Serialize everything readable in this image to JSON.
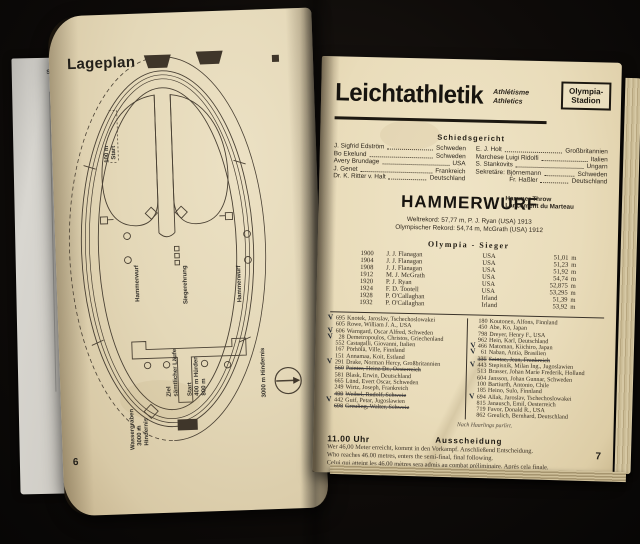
{
  "book": {
    "left_page_number": "6",
    "right_page_number": "7",
    "inserted_sheet_text": "Sc"
  },
  "lageplan": {
    "title": "Lageplan",
    "labels": {
      "start100_l1": "100 m",
      "start100_l2": "Start",
      "hammerwurf_left": "Hammerwurf",
      "hammerwurf_right": "Hammerwurf",
      "siegerehrung": "Siegerehrung",
      "ziel_l1": "Ziel",
      "ziel_l2": "sämtlicher Läufe",
      "start400_l1": "Start",
      "start400_l2": "400 m Hürden",
      "start400_l3": "800 m",
      "wassergraben_l1": "Wassergraben",
      "wassergraben_l2": "3000 m",
      "wassergraben_l3": "Hindernis",
      "hindernis_right": "3000 m Hindernis"
    }
  },
  "header": {
    "title": "Leichtathletik",
    "subtitle_fr": "Athlétisme",
    "subtitle_en": "Athletics",
    "venue_line1": "Olympia-",
    "venue_line2": "Stadion"
  },
  "schiedsgericht": {
    "heading": "Schiedsgericht",
    "left": [
      {
        "name": "J. Sigfrid Edström",
        "country": "Schweden"
      },
      {
        "name": "Bo Ekelund",
        "country": "Schweden"
      },
      {
        "name": "Avery Brundage",
        "country": "USA"
      },
      {
        "name": "J. Genet",
        "country": "Frankreich"
      },
      {
        "name": "Dr. K. Ritter v. Halt",
        "country": "Deutschland"
      }
    ],
    "right": [
      {
        "name": "E. J. Holt",
        "country": "Großbritannien",
        "indent": false
      },
      {
        "name": "Marchese Luigi Ridolfi",
        "country": "Italien",
        "indent": false
      },
      {
        "name": "S. Stankovits",
        "country": "Ungarn",
        "indent": false
      },
      {
        "name": "Sekretäre: Björnemann",
        "country": "Schweden",
        "indent": false
      },
      {
        "name": "Fr. Haßler",
        "country": "Deutschland",
        "indent": true
      }
    ]
  },
  "hammerwurf": {
    "title": "HAMMERWURF",
    "subtitle_en": "Hammer Throw",
    "subtitle_fr": "Lancement du Marteau",
    "weltrekord": "Weltrekord: 57,77 m, P. J. Ryan (USA) 1913",
    "olympischer_rekord": "Olympischer Rekord: 54,74 m, McGrath (USA) 1912",
    "sieger_heading": "Olympia - Sieger",
    "winners": [
      {
        "year": "1900",
        "name": "J. J. Flanagan",
        "country": "USA",
        "distance": "51,01"
      },
      {
        "year": "1904",
        "name": "J. J. Flanagan",
        "country": "USA",
        "distance": "51,23"
      },
      {
        "year": "1908",
        "name": "J. J. Flanagan",
        "country": "USA",
        "distance": "51,92"
      },
      {
        "year": "1912",
        "name": "M. J. McGrath",
        "country": "USA",
        "distance": "54,74"
      },
      {
        "year": "1920",
        "name": "P. J. Ryan",
        "country": "USA",
        "distance": "52,875"
      },
      {
        "year": "1924",
        "name": "F. D. Tootell",
        "country": "USA",
        "distance": "53,295"
      },
      {
        "year": "1928",
        "name": "P. O'Callaghan",
        "country": "Irland",
        "distance": "51,39"
      },
      {
        "year": "1932",
        "name": "P. O'Callaghan",
        "country": "Irland",
        "distance": "53,92"
      }
    ],
    "meter_unit": "m",
    "competitors_left": [
      {
        "num": "695",
        "name": "Knotek, Jaroslav, Tschechoslowakei",
        "checked": true,
        "struck": false
      },
      {
        "num": "605",
        "name": "Rowe, William J. A., USA",
        "checked": false,
        "struck": false
      },
      {
        "num": "606",
        "name": "Warngard, Oscar Alfred, Schweden",
        "checked": true,
        "struck": false
      },
      {
        "num": "28",
        "name": "Demetropoulos, Christos, Griechenland",
        "checked": true,
        "struck": false
      },
      {
        "num": "552",
        "name": "Castagalli, Giovanni, Italien",
        "checked": false,
        "struck": false
      },
      {
        "num": "167",
        "name": "Pörhölä, Ville, Finnland",
        "checked": false,
        "struck": false
      },
      {
        "num": "151",
        "name": "Annamaa, Koit, Estland",
        "checked": false,
        "struck": false
      },
      {
        "num": "291",
        "name": "Drake, Norman Hercy, Großbritannien",
        "checked": true,
        "struck": false
      },
      {
        "num": "560",
        "name": "Painter, Heinz Dr., Oesterreich",
        "checked": false,
        "struck": true
      },
      {
        "num": "581",
        "name": "Blask, Erwin, Deutschland",
        "checked": false,
        "struck": false
      },
      {
        "num": "665",
        "name": "Lünd, Evert Oscar, Schweden",
        "checked": false,
        "struck": false
      },
      {
        "num": "249",
        "name": "Wirtz, Joseph, Frankreich",
        "checked": false,
        "struck": false
      },
      {
        "num": "499",
        "name": "Weibel, Rudolf, Schweiz",
        "checked": false,
        "struck": true
      },
      {
        "num": "442",
        "name": "Guif, Petar, Jugoslawien",
        "checked": true,
        "struck": false
      },
      {
        "num": "698",
        "name": "Greuling, Walter, Schweiz",
        "checked": false,
        "struck": true
      }
    ],
    "competitors_right": [
      {
        "num": "180",
        "name": "Koutonen, Alfons, Finnland",
        "checked": false,
        "struck": false
      },
      {
        "num": "450",
        "name": "Abe, Ko, Japan",
        "checked": false,
        "struck": false
      },
      {
        "num": "798",
        "name": "Dreyer, Henry F., USA",
        "checked": false,
        "struck": false
      },
      {
        "num": "962",
        "name": "Hein, Karl, Deutschland",
        "checked": false,
        "struck": false
      },
      {
        "num": "466",
        "name": "Matoman, Kiichiro, Japan",
        "checked": true,
        "struck": false
      },
      {
        "num": "61",
        "name": "Naban, Antia, Brasilien",
        "checked": true,
        "struck": false
      },
      {
        "num": "335",
        "name": "Saintae, Jean, Frankreich",
        "checked": false,
        "struck": true
      },
      {
        "num": "443",
        "name": "Stepisnik, Milan Ing., Jugoslawien",
        "checked": true,
        "struck": false
      },
      {
        "num": "513",
        "name": "Brasser, Johan Marie Frederik, Holland",
        "checked": false,
        "struck": false
      },
      {
        "num": "604",
        "name": "Jansson, Johan Gunnar, Schweden",
        "checked": false,
        "struck": false
      },
      {
        "num": "100",
        "name": "Bartiurth, Antonio, Chile",
        "checked": false,
        "struck": false
      },
      {
        "num": "185",
        "name": "Heino, Sulo, Finnland",
        "checked": false,
        "struck": false
      },
      {
        "num": "694",
        "name": "Allak, Jaroslav, Tschechoslowakei",
        "checked": true,
        "struck": false
      },
      {
        "num": "815",
        "name": "Janausch, Emil, Oesterreich",
        "checked": false,
        "struck": false
      },
      {
        "num": "719",
        "name": "Favor, Donald R., USA",
        "checked": false,
        "struck": false
      },
      {
        "num": "862",
        "name": "Greulich, Bernhard, Deutschland",
        "checked": false,
        "struck": false
      }
    ],
    "note": "Nach Haarlings parlirt.",
    "schedule_time": "11.00 Uhr",
    "schedule_heading": "Ausscheidung",
    "text_de": "Wer 46,00 Meter erreicht, kommt in den Vorkampf. Anschließend Entscheidung.",
    "text_en": "Who reaches 46.00 metres, enters the semi-final, final following.",
    "text_fr": "Celui qui atteint les 46,00 mètres sera admis au combat préliminaire. Après cela finale."
  }
}
